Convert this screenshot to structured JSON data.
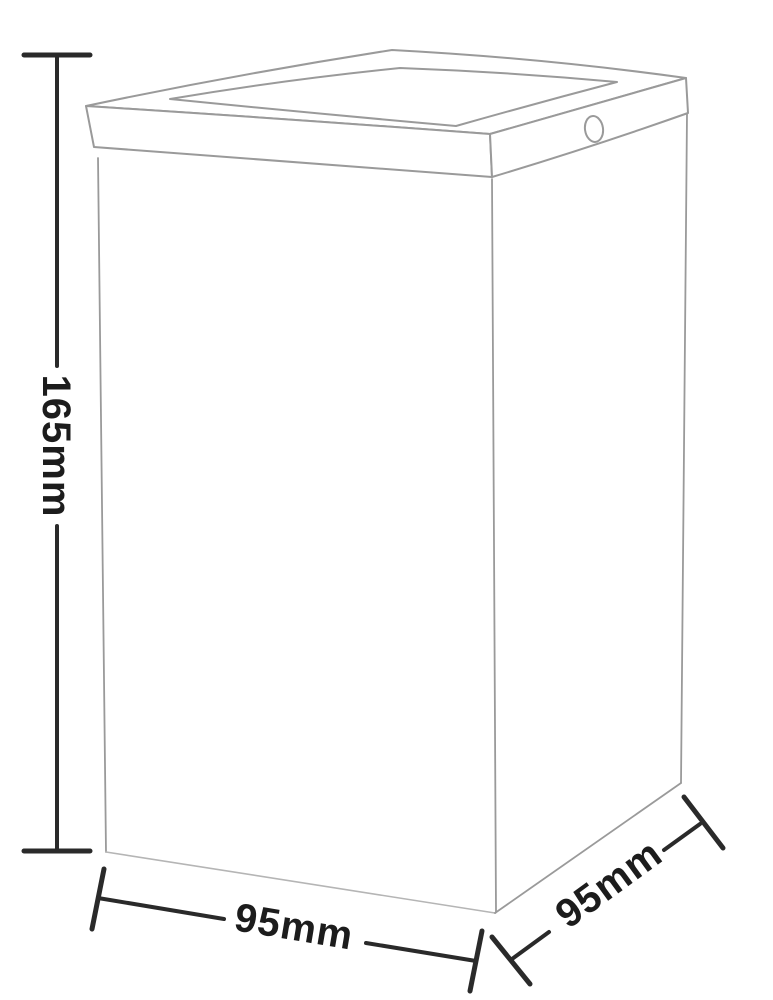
{
  "figure": {
    "dimensions": {
      "height": {
        "label": "165mm"
      },
      "width": {
        "label": "95mm"
      },
      "depth": {
        "label": "95mm"
      }
    },
    "colors": {
      "background": "#ffffff",
      "outline": "#9a9a9a",
      "outline_light": "#b5b5b5",
      "dimension_line": "#2a2a2a",
      "label_text": "#1c1c1c"
    }
  }
}
